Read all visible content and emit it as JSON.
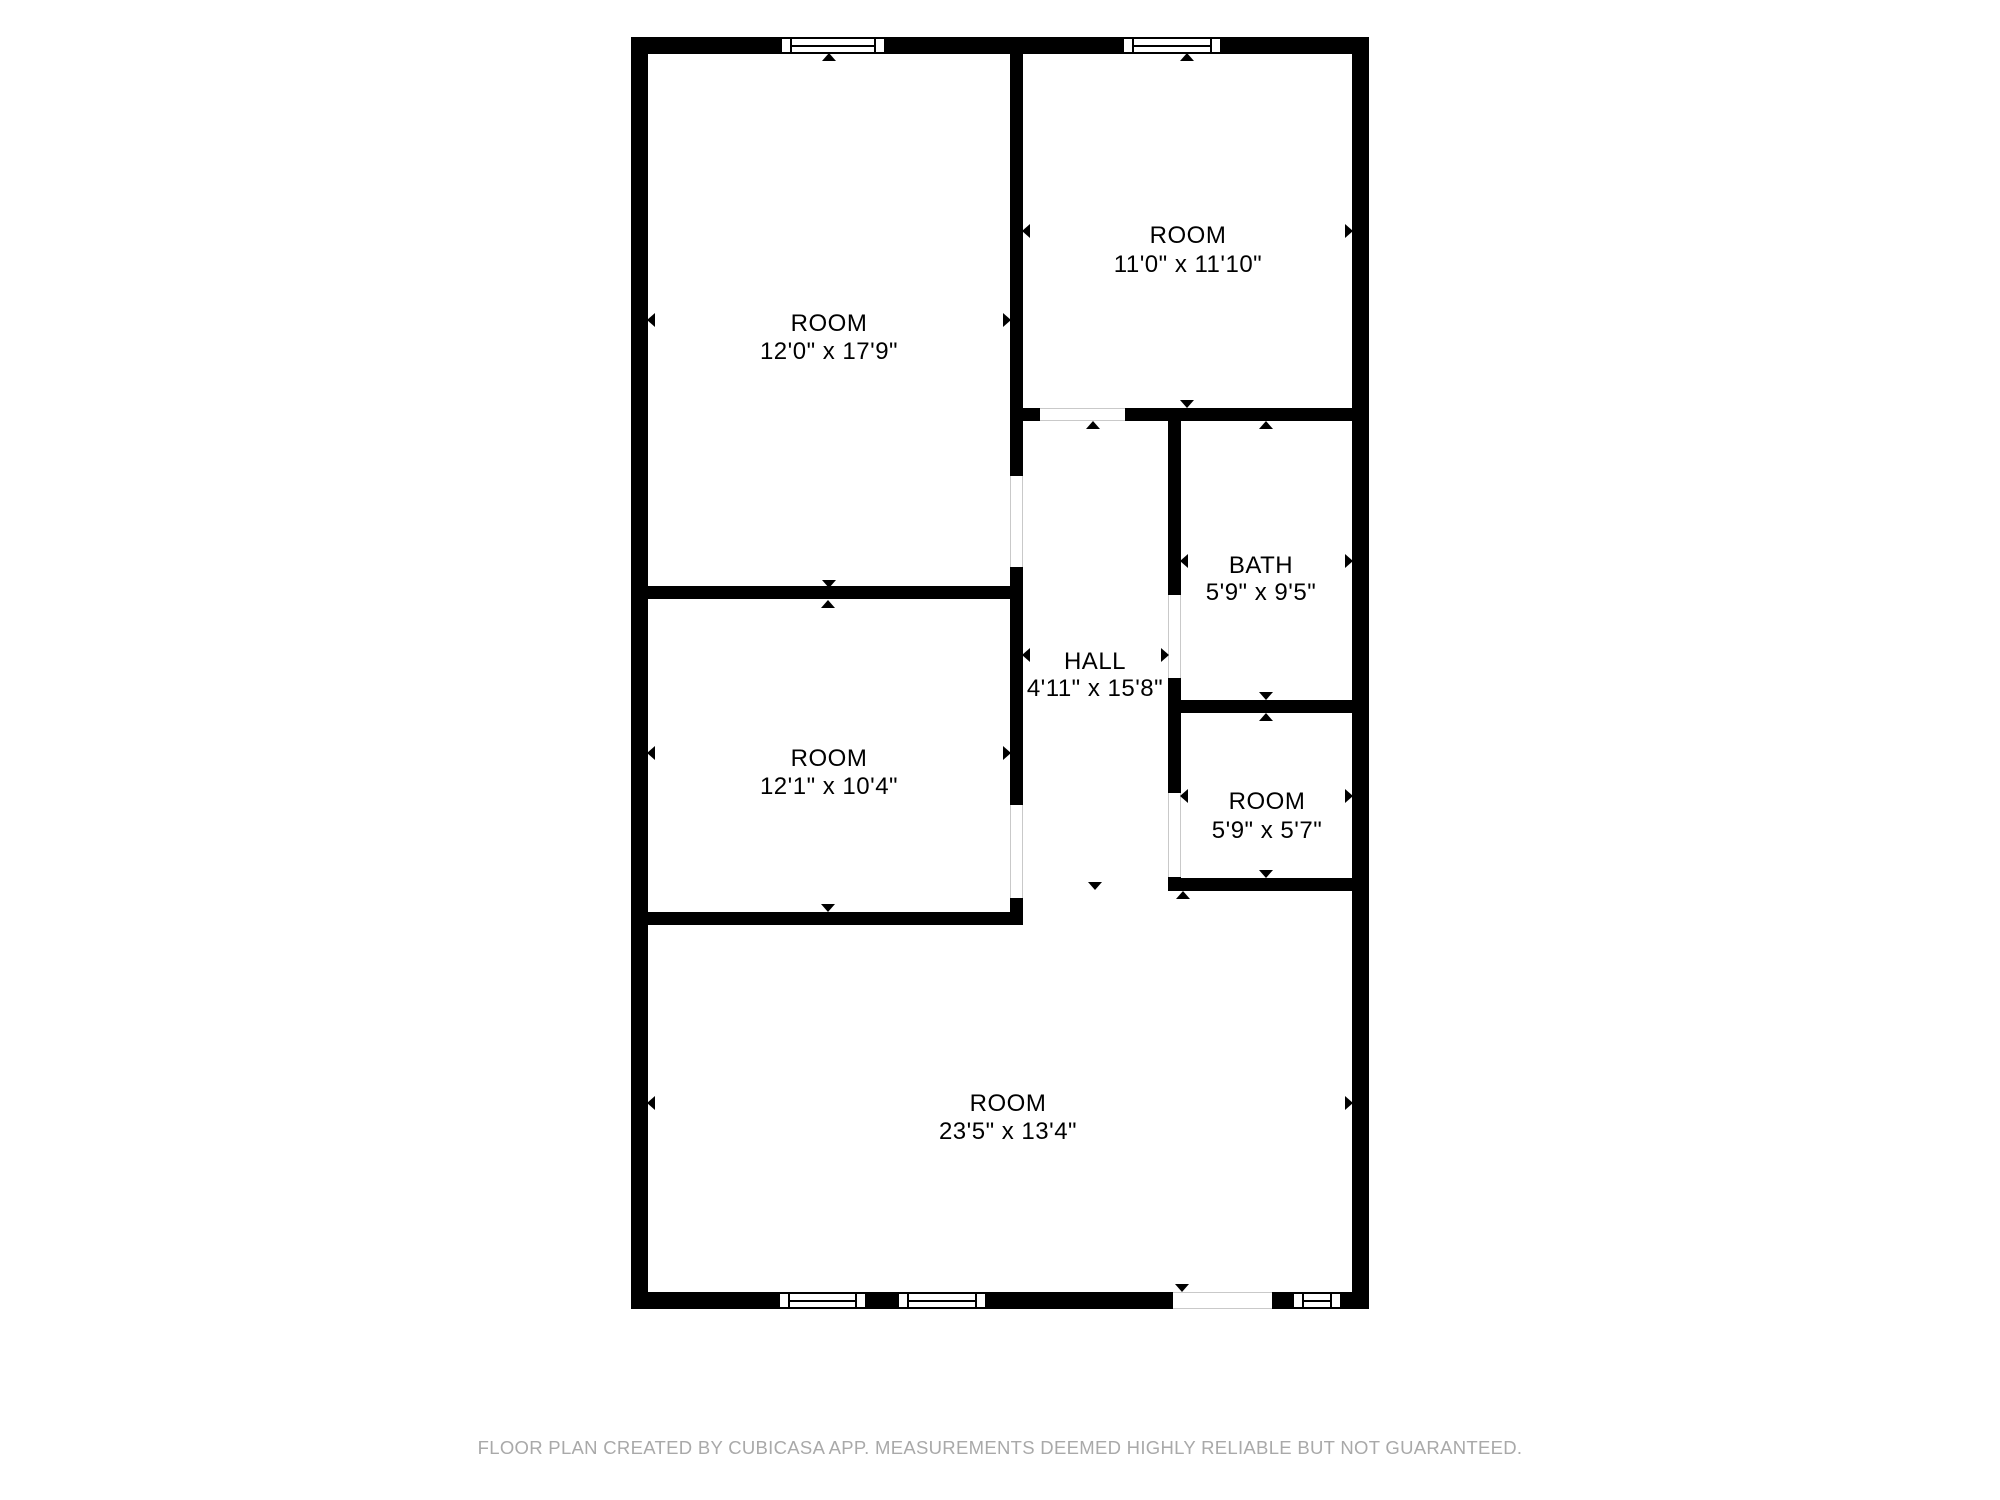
{
  "floorplan": {
    "wall_color": "#000000",
    "label_color": "#000000",
    "rooms": [
      {
        "id": "room-top-left",
        "name": "ROOM",
        "dims": "12'0\" x 17'9\"",
        "cx": 829,
        "name_cy": 324,
        "dims_cy": 352
      },
      {
        "id": "room-top-right",
        "name": "ROOM",
        "dims": "11'0\" x 11'10\"",
        "cx": 1188,
        "name_cy": 236,
        "dims_cy": 265
      },
      {
        "id": "bath",
        "name": "BATH",
        "dims": "5'9\" x 9'5\"",
        "cx": 1261,
        "name_cy": 566,
        "dims_cy": 593
      },
      {
        "id": "hall",
        "name": "HALL",
        "dims": "4'11\" x 15'8\"",
        "cx": 1095,
        "name_cy": 662,
        "dims_cy": 689
      },
      {
        "id": "room-mid-left",
        "name": "ROOM",
        "dims": "12'1\" x 10'4\"",
        "cx": 829,
        "name_cy": 759,
        "dims_cy": 787
      },
      {
        "id": "room-small",
        "name": "ROOM",
        "dims": "5'9\" x 5'7\"",
        "cx": 1267,
        "name_cy": 802,
        "dims_cy": 831
      },
      {
        "id": "room-bottom",
        "name": "ROOM",
        "dims": "23'5\" x 13'4\"",
        "cx": 1008,
        "name_cy": 1104,
        "dims_cy": 1132
      }
    ],
    "walls": [
      {
        "name": "exterior-top",
        "x": 631,
        "y": 37,
        "w": 738,
        "h": 17
      },
      {
        "name": "exterior-bottom",
        "x": 631,
        "y": 1292,
        "w": 738,
        "h": 17
      },
      {
        "name": "exterior-left",
        "x": 631,
        "y": 37,
        "w": 17,
        "h": 1272
      },
      {
        "name": "exterior-right",
        "x": 1352,
        "y": 37,
        "w": 17,
        "h": 1272
      },
      {
        "name": "divider-center-upper",
        "x": 1010,
        "y": 54,
        "w": 13,
        "h": 422
      },
      {
        "name": "divider-center-middle",
        "x": 1010,
        "y": 567,
        "w": 13,
        "h": 238
      },
      {
        "name": "divider-center-stub",
        "x": 1010,
        "y": 898,
        "w": 13,
        "h": 27
      },
      {
        "name": "hall-right-upper",
        "x": 1168,
        "y": 421,
        "w": 13,
        "h": 174
      },
      {
        "name": "hall-right-middle",
        "x": 1168,
        "y": 678,
        "w": 13,
        "h": 115
      },
      {
        "name": "hall-right-stub",
        "x": 1168,
        "y": 877,
        "w": 13,
        "h": 14
      },
      {
        "name": "topright-bottom-stub",
        "x": 1023,
        "y": 408,
        "w": 17,
        "h": 13
      },
      {
        "name": "topright-bottom-main",
        "x": 1125,
        "y": 408,
        "w": 227,
        "h": 13
      },
      {
        "name": "left-rooms-divider",
        "x": 648,
        "y": 586,
        "w": 362,
        "h": 13
      },
      {
        "name": "midleft-bottom",
        "x": 648,
        "y": 912,
        "w": 375,
        "h": 13
      },
      {
        "name": "bath-smallroom-divider",
        "x": 1181,
        "y": 700,
        "w": 171,
        "h": 13
      },
      {
        "name": "smallroom-bottom",
        "x": 1168,
        "y": 878,
        "w": 184,
        "h": 13
      }
    ],
    "openings": [
      {
        "name": "door-top-left-room",
        "dir": "v",
        "x": 1010,
        "y": 476,
        "w": 13,
        "h": 91
      },
      {
        "name": "door-mid-left-room",
        "dir": "v",
        "x": 1010,
        "y": 805,
        "w": 13,
        "h": 93
      },
      {
        "name": "door-top-right-room",
        "dir": "h",
        "x": 1040,
        "y": 408,
        "w": 85,
        "h": 13
      },
      {
        "name": "door-bath",
        "dir": "v",
        "x": 1168,
        "y": 595,
        "w": 13,
        "h": 83
      },
      {
        "name": "door-small-room",
        "dir": "v",
        "x": 1168,
        "y": 793,
        "w": 13,
        "h": 84
      },
      {
        "name": "entry-opening-bottom",
        "dir": "h",
        "x": 1173,
        "y": 1292,
        "w": 99,
        "h": 17
      }
    ],
    "windows": [
      {
        "name": "window-top-left",
        "x": 780,
        "y": 37,
        "w": 106,
        "h": 17
      },
      {
        "name": "window-top-right",
        "x": 1122,
        "y": 37,
        "w": 100,
        "h": 17
      },
      {
        "name": "window-bottom-1",
        "x": 778,
        "y": 1292,
        "w": 89,
        "h": 17
      },
      {
        "name": "window-bottom-2",
        "x": 897,
        "y": 1292,
        "w": 90,
        "h": 17
      },
      {
        "name": "window-bottom-right",
        "x": 1292,
        "y": 1292,
        "w": 50,
        "h": 17
      }
    ],
    "arrows": [
      {
        "dir": "up",
        "x": 829,
        "y": 57
      },
      {
        "dir": "down",
        "x": 829,
        "y": 584
      },
      {
        "dir": "left",
        "x": 651,
        "y": 320
      },
      {
        "dir": "right",
        "x": 1007,
        "y": 320
      },
      {
        "dir": "up",
        "x": 1187,
        "y": 57
      },
      {
        "dir": "down",
        "x": 1187,
        "y": 404
      },
      {
        "dir": "left",
        "x": 1026,
        "y": 231
      },
      {
        "dir": "right",
        "x": 1349,
        "y": 231
      },
      {
        "dir": "up",
        "x": 1093,
        "y": 425
      },
      {
        "dir": "down",
        "x": 1095,
        "y": 886
      },
      {
        "dir": "left",
        "x": 1026,
        "y": 655
      },
      {
        "dir": "right",
        "x": 1165,
        "y": 655
      },
      {
        "dir": "up",
        "x": 1266,
        "y": 425
      },
      {
        "dir": "down",
        "x": 1266,
        "y": 696
      },
      {
        "dir": "left",
        "x": 1184,
        "y": 561
      },
      {
        "dir": "right",
        "x": 1349,
        "y": 561
      },
      {
        "dir": "up",
        "x": 1266,
        "y": 717
      },
      {
        "dir": "down",
        "x": 1266,
        "y": 874
      },
      {
        "dir": "left",
        "x": 1184,
        "y": 796
      },
      {
        "dir": "right",
        "x": 1349,
        "y": 796
      },
      {
        "dir": "up",
        "x": 828,
        "y": 604
      },
      {
        "dir": "down",
        "x": 828,
        "y": 908
      },
      {
        "dir": "left",
        "x": 651,
        "y": 753
      },
      {
        "dir": "right",
        "x": 1007,
        "y": 753
      },
      {
        "dir": "up",
        "x": 1183,
        "y": 895
      },
      {
        "dir": "down",
        "x": 1182,
        "y": 1288
      },
      {
        "dir": "left",
        "x": 651,
        "y": 1103
      },
      {
        "dir": "right",
        "x": 1349,
        "y": 1103
      }
    ]
  },
  "footer": {
    "text": "FLOOR PLAN CREATED BY CUBICASA APP. MEASUREMENTS DEEMED HIGHLY RELIABLE BUT NOT GUARANTEED.",
    "color": "#a9a9a9"
  }
}
